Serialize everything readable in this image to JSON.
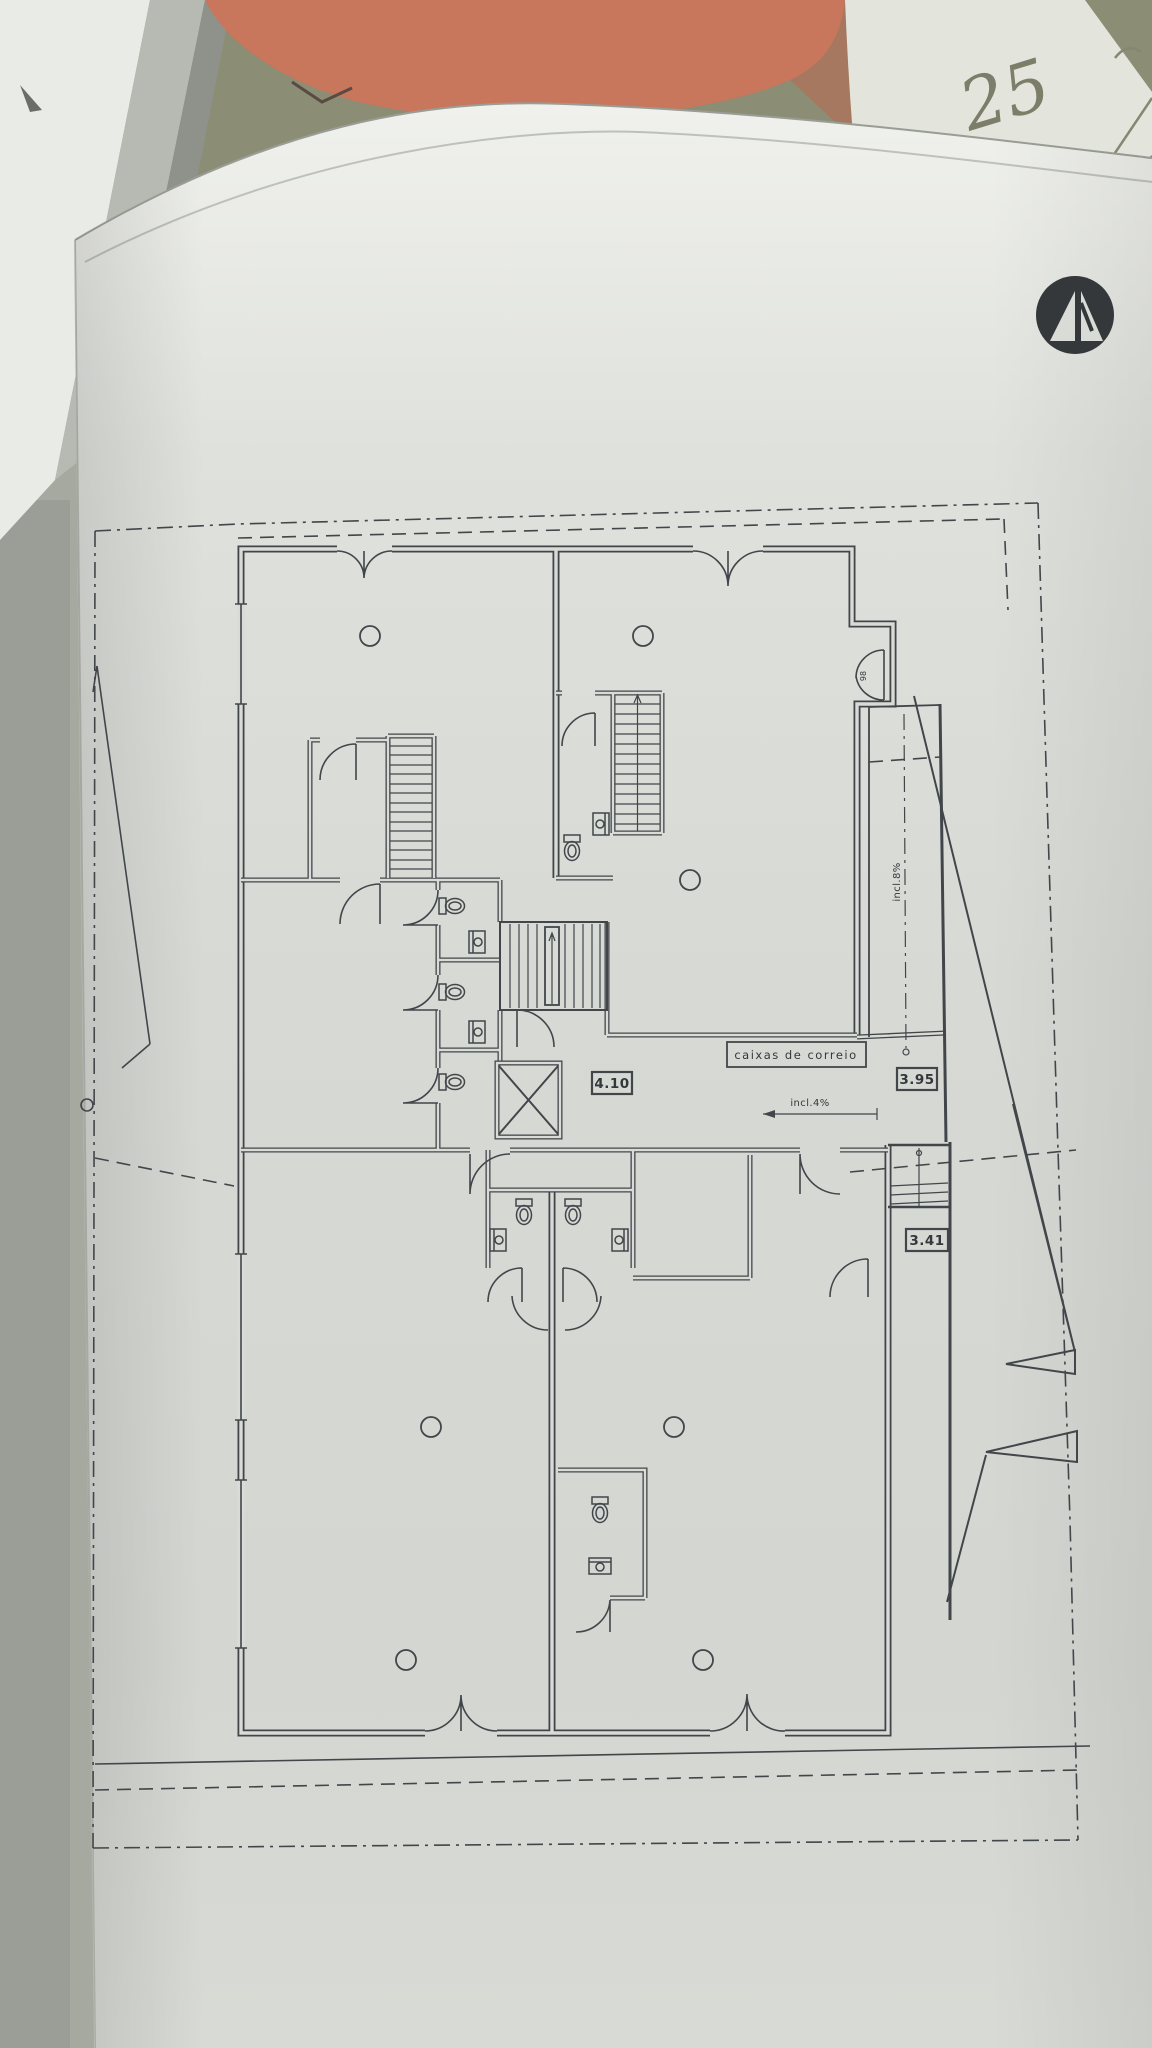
{
  "photo": {
    "handwritten_number": "25"
  },
  "colors": {
    "backdrop": "#a6a99f",
    "window_frame": "#e9ebe7",
    "frame_shadow": "#b7bab2",
    "salmon_object": "#c8765c",
    "olive_top": "#8b8d74",
    "under_sheet": "#e3e5dc",
    "pencil": "#7c7e6a",
    "sheet_top": "#f0f1ed",
    "sheet_base": "#d6d8d4",
    "ink": "#41464a",
    "logo": "#34383a"
  },
  "plan": {
    "labels": {
      "mailboxes": "caixas de correio",
      "hall_width": "4.10",
      "ramp_upper": "3.95",
      "ramp_lower": "3.41",
      "slope_horizontal": "incl.4%",
      "slope_vertical": "incl.8%",
      "entrance_door_mark": "98"
    }
  }
}
